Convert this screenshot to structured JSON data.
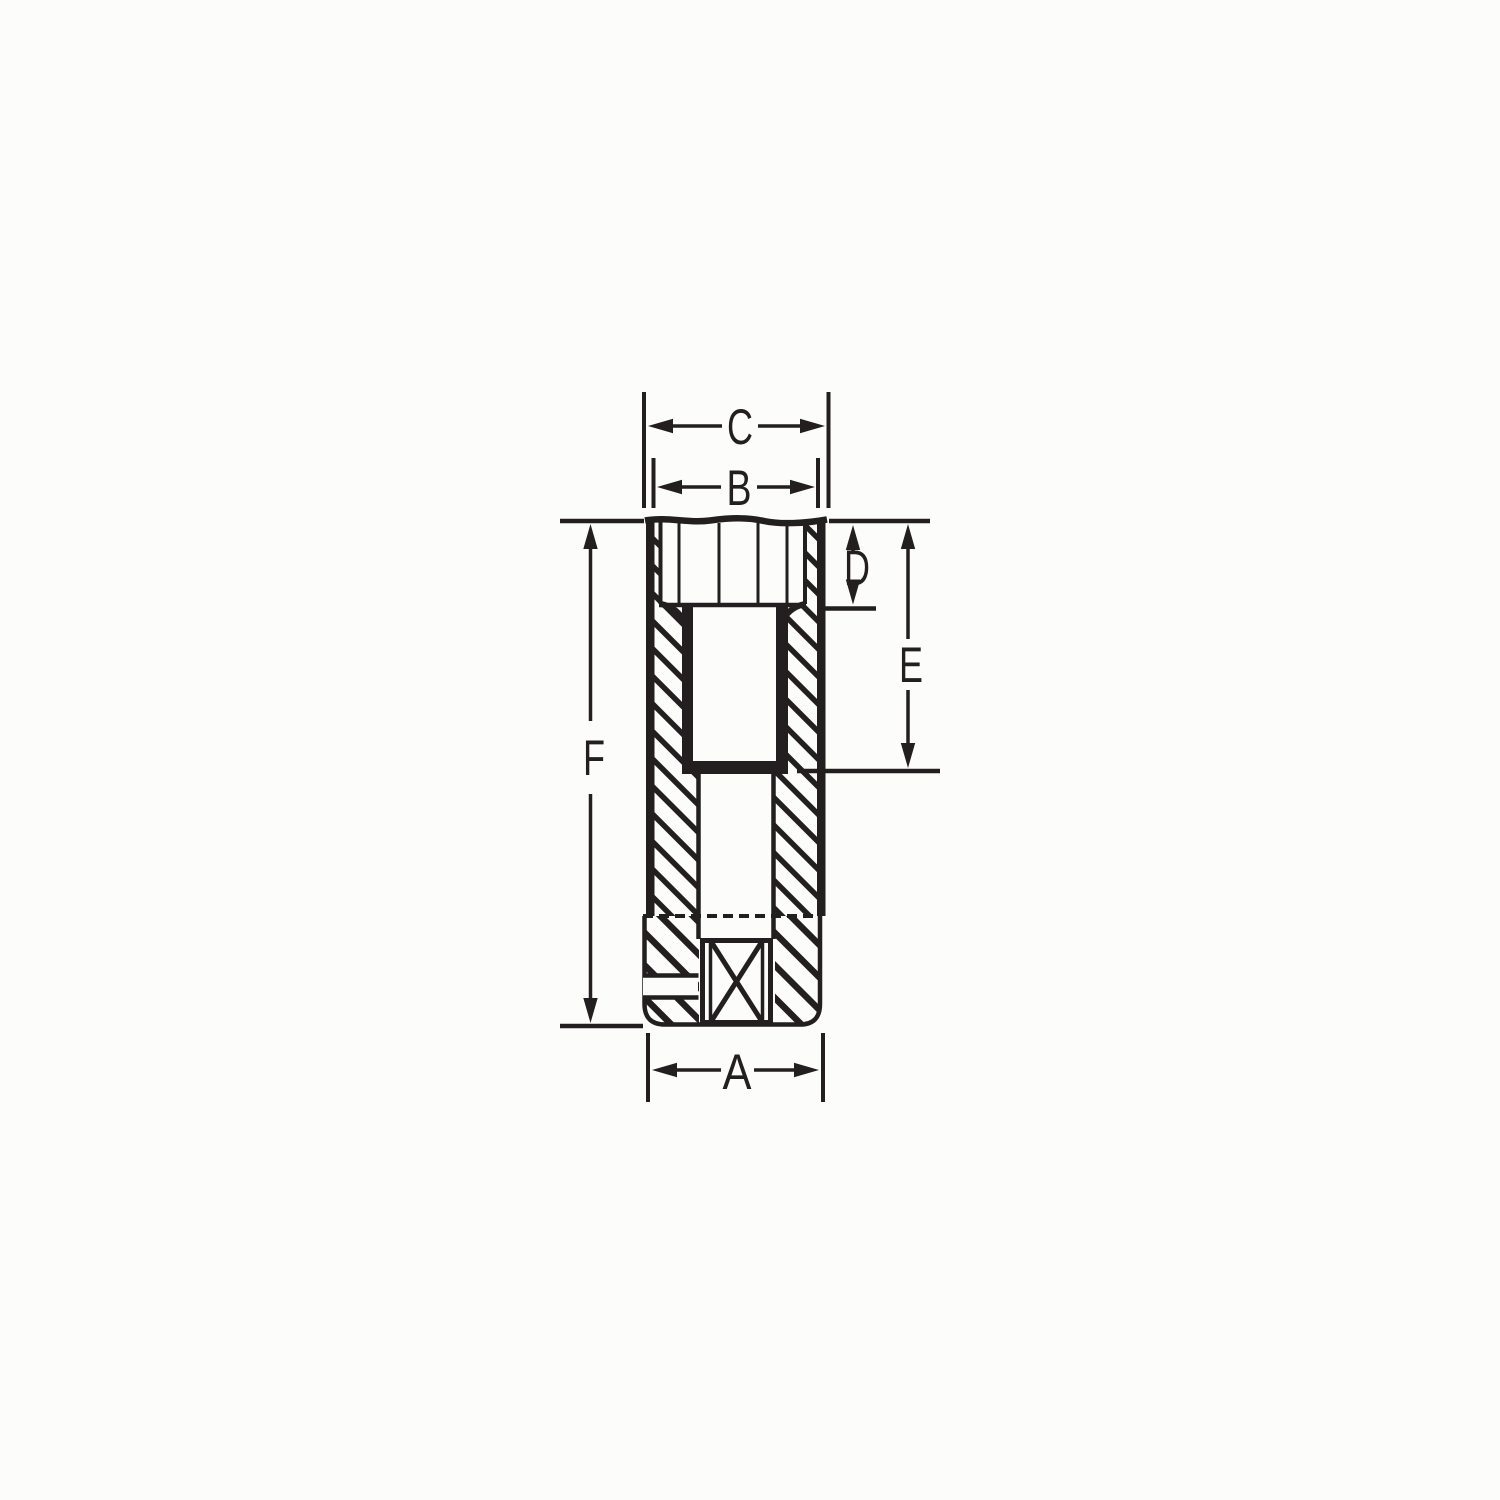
{
  "diagram": {
    "labels": {
      "A": "A",
      "B": "B",
      "C": "C",
      "D": "D",
      "E": "E",
      "F": "F"
    }
  },
  "colors": {
    "ink": "#231f20",
    "background": "#fcfcfa"
  }
}
